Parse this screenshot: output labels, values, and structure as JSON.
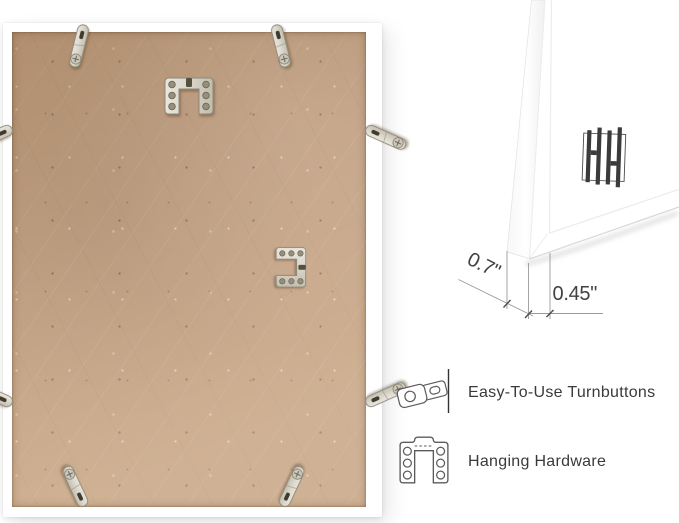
{
  "measurements": {
    "depth": "0.7\"",
    "face_width": "0.45\""
  },
  "features": [
    {
      "icon": "turnbutton-icon",
      "label": "Easy-To-Use Turnbuttons"
    },
    {
      "icon": "hanging-hardware-icon",
      "label": "Hanging Hardware"
    }
  ],
  "logo": {
    "name": "brand-hh-logo"
  },
  "colors": {
    "background": "#ffffff",
    "frame_white": "#ffffff",
    "mdf_board": "#c2a183",
    "metal": "#d6d2c8",
    "dimension_line": "#9a9a9a",
    "text": "#3d3d3d"
  }
}
